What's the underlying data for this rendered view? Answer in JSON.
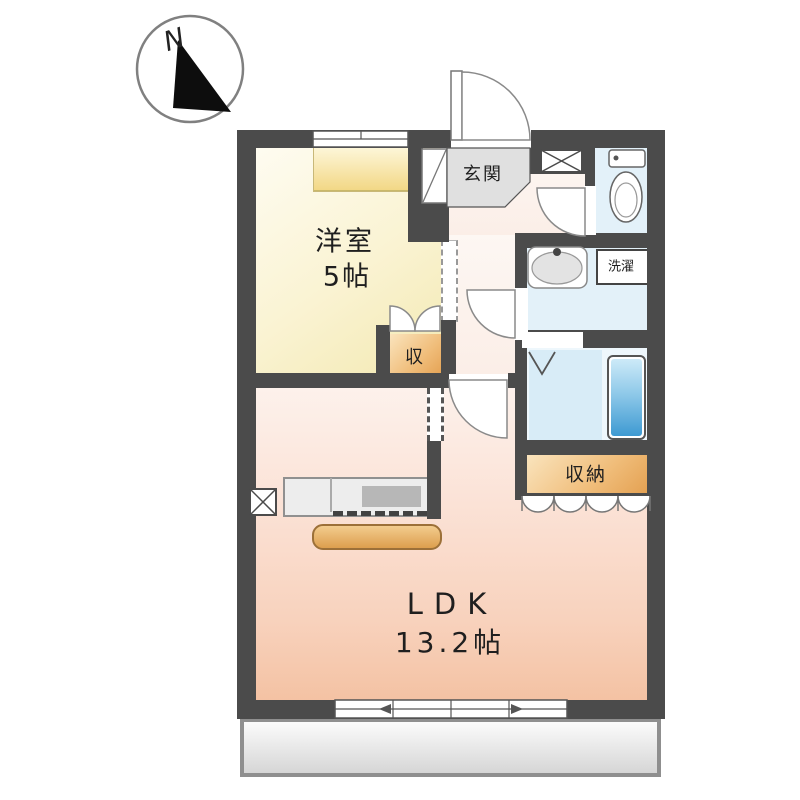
{
  "compass": {
    "north_label": "N"
  },
  "rooms": {
    "western_room": {
      "name": "洋室",
      "size": "5帖"
    },
    "ldk": {
      "name": "LDK",
      "size": "13.2帖"
    },
    "entrance": {
      "label": "玄関"
    },
    "closet": {
      "label": "収"
    },
    "storage": {
      "label": "収納"
    },
    "laundry": {
      "label": "洗濯"
    }
  },
  "palette": {
    "wall": "#4b4b4b",
    "western_room_floor": "#faf3d2",
    "ldk_floor": "#f8d2bd",
    "wet_area_floor": "#e3f1f9",
    "bathtub": "#3e9ad2",
    "closet_fill": "#f0bd7a",
    "entrance_fill": "#e0e0e0",
    "balcony_fill": "#e2e2e2"
  }
}
